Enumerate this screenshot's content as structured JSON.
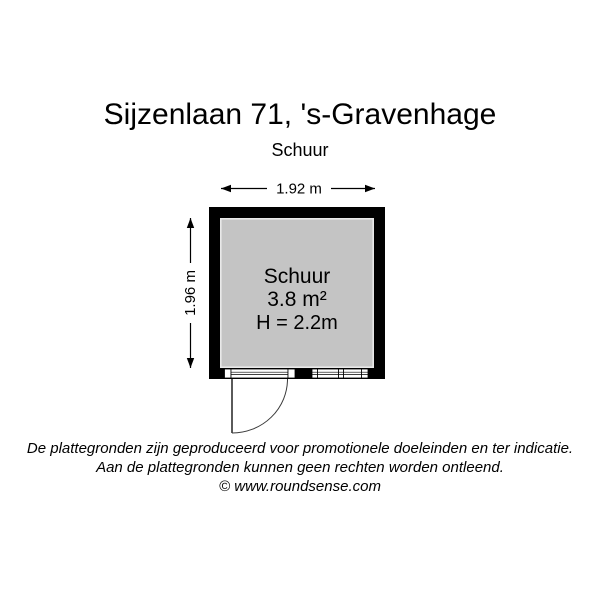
{
  "title": "Sijzenlaan 71, 's-Gravenhage",
  "subtitle": "Schuur",
  "floorplan": {
    "width_label": "1.92 m",
    "height_label": "1.96 m",
    "room": {
      "name": "Schuur",
      "area": "3.8 m²",
      "ceiling_height": "H = 2.2m"
    },
    "colors": {
      "wall": "#000000",
      "floor": "#c4c4c4",
      "floor_edge": "#e9e9e9",
      "background": "#ffffff"
    }
  },
  "footer": {
    "line1": "De plattegronden zijn geproduceerd voor promotionele doeleinden en ter indicatie.",
    "line2": "Aan de plattegronden kunnen geen rechten worden ontleend.",
    "line3": "© www.roundsense.com"
  }
}
